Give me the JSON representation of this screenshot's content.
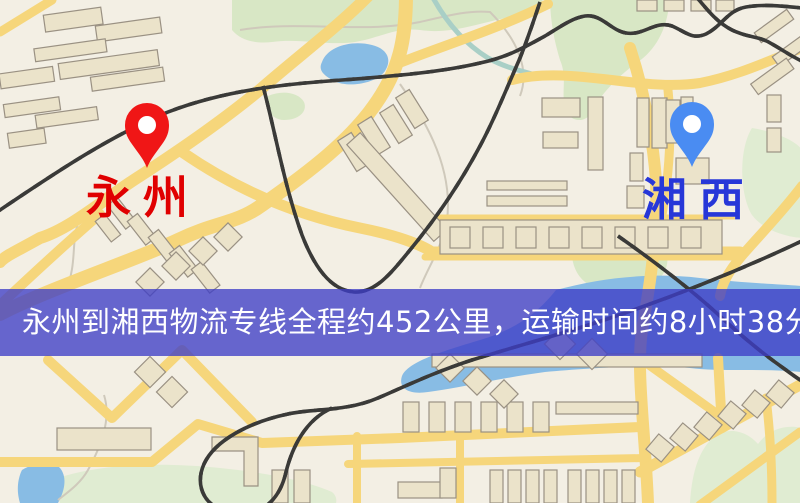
{
  "map": {
    "banner": {
      "text": "永州到湘西物流专线全程约452公里，运输时间约8小时38分钟."
    },
    "route": {
      "from": "永州",
      "to": "湘西",
      "distance": "约452公里",
      "duration": "约8小时38分钟"
    },
    "markers": [
      {
        "name": "origin",
        "label": "永州"
      },
      {
        "name": "destination",
        "label": "湘西"
      }
    ],
    "colors": {
      "mapBg": "#f3efe4",
      "road": "#f6d67b",
      "roadLight": "#f8e49e",
      "building": "#ebe3ca",
      "buildingStroke": "#9a9183",
      "park": "#d8e7c5",
      "parkLight": "#e0ecd2",
      "water": "#88bce4",
      "stream": "#a9cfc6",
      "contour": "#cfc9bb",
      "railway": "#3a3a38",
      "railwayDash": "#ffffff",
      "bannerBg": "rgba(62,62,199,0.78)",
      "bannerText": "#ffffff",
      "pinOrigin": "#f01616",
      "pinOriginLabel": "#e00000",
      "pinDest": "#4a8cf2",
      "pinDestLabel": "#2737d8",
      "pinHole": "#ffffff"
    }
  }
}
